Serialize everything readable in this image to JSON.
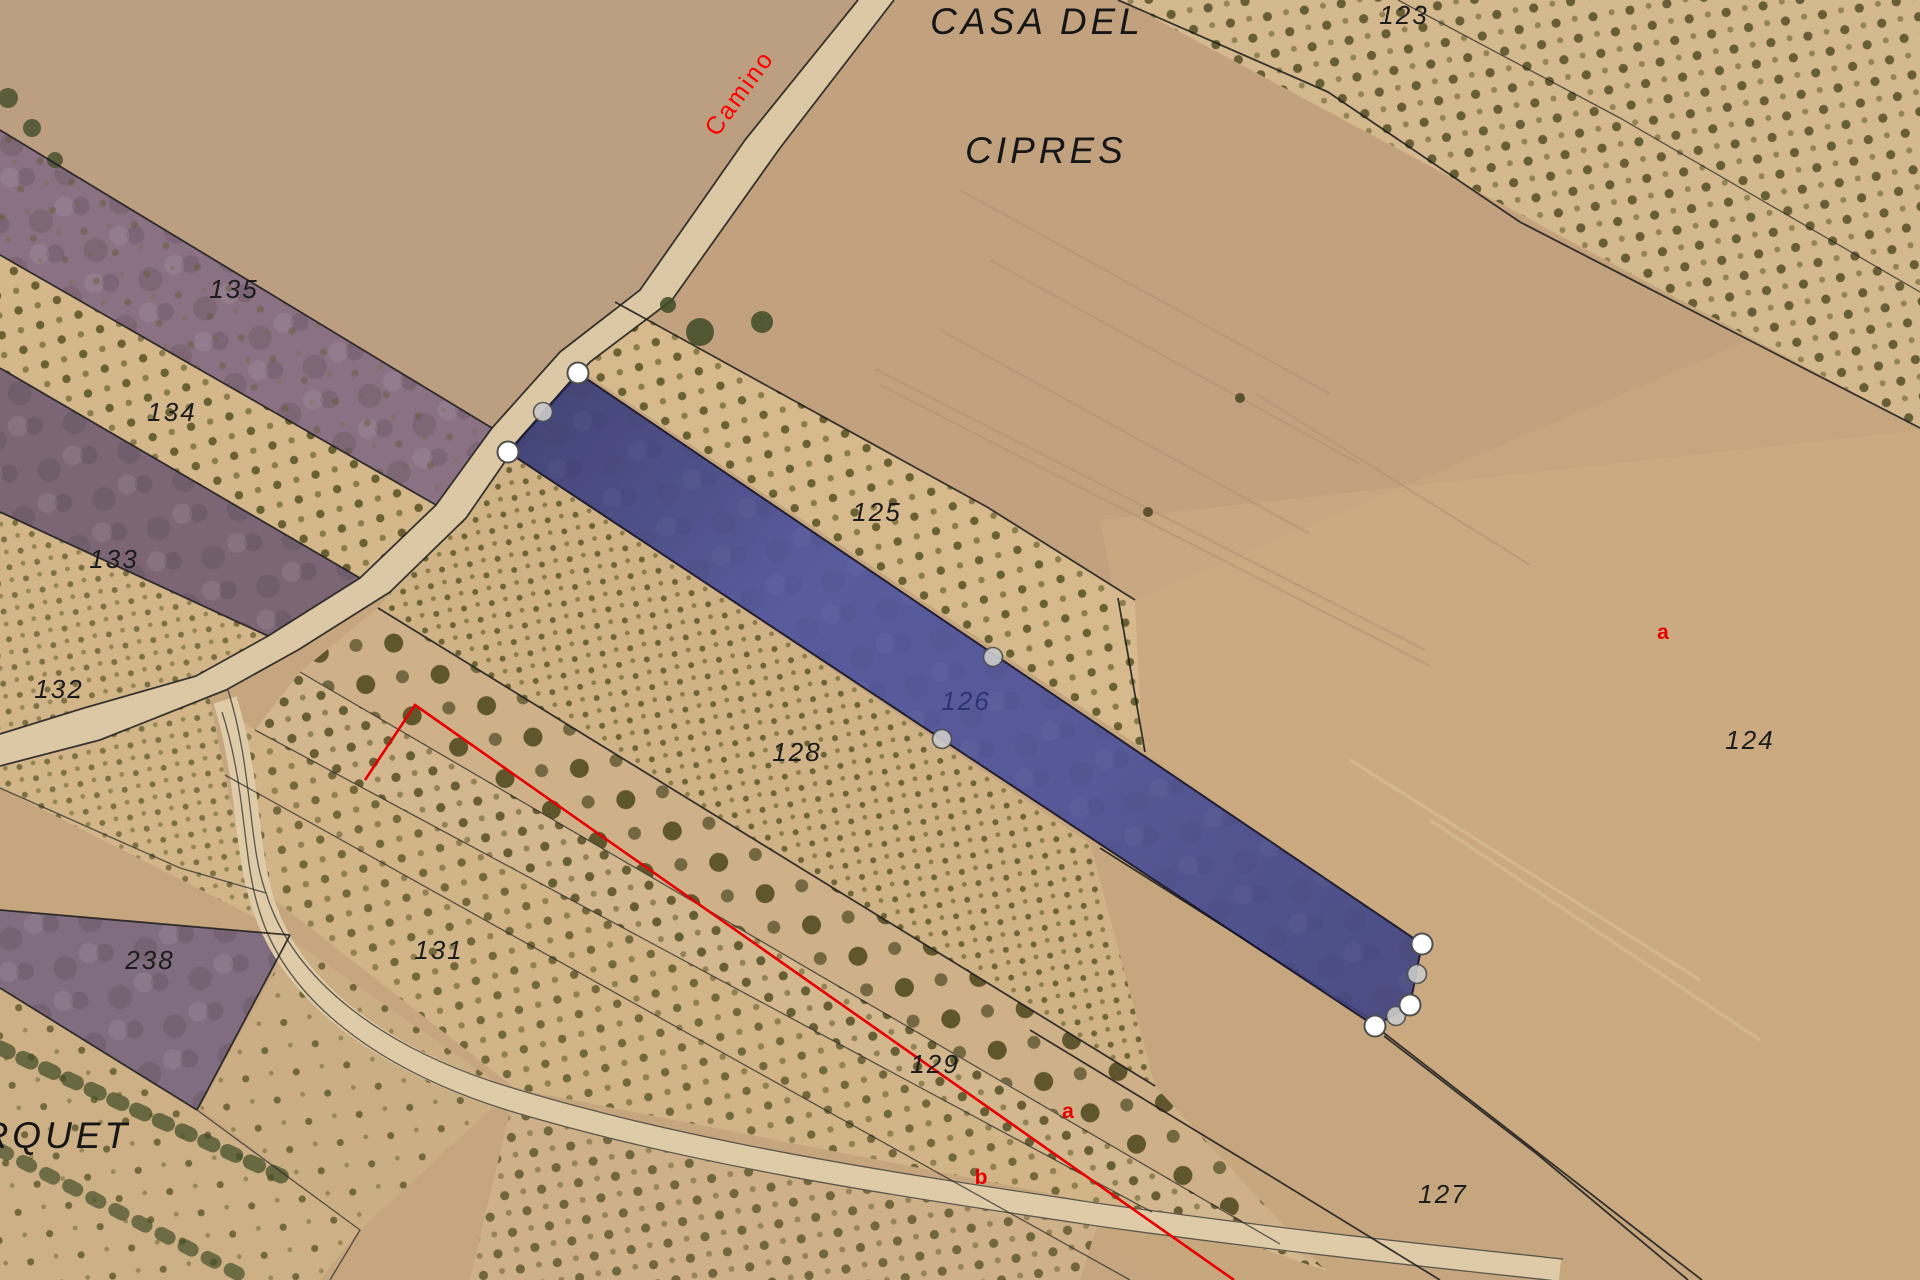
{
  "map": {
    "type": "cadastral-aerial-map",
    "place_labels": [
      {
        "id": "casa-del",
        "text": "CASA DEL",
        "x": 1037,
        "y": 34
      },
      {
        "id": "cipres",
        "text": "CIPRES",
        "x": 1046,
        "y": 163
      },
      {
        "id": "arquet",
        "text": "ARQUET",
        "x": 42,
        "y": 1148
      }
    ],
    "road_label": {
      "text": "Camino",
      "x": 746,
      "y": 98,
      "rotation": -54,
      "color": "#ff0000"
    },
    "parcel_labels": [
      {
        "number": "123",
        "x": 1404,
        "y": 24
      },
      {
        "number": "135",
        "x": 234,
        "y": 298
      },
      {
        "number": "134",
        "x": 172,
        "y": 421
      },
      {
        "number": "133",
        "x": 114,
        "y": 568
      },
      {
        "number": "132",
        "x": 59,
        "y": 698
      },
      {
        "number": "125",
        "x": 877,
        "y": 521
      },
      {
        "number": "126",
        "x": 966,
        "y": 710,
        "on_selection": true
      },
      {
        "number": "128",
        "x": 797,
        "y": 761
      },
      {
        "number": "124",
        "x": 1750,
        "y": 749
      },
      {
        "number": "238",
        "x": 150,
        "y": 969
      },
      {
        "number": "131",
        "x": 439,
        "y": 959
      },
      {
        "number": "129",
        "x": 935,
        "y": 1073
      },
      {
        "number": "127",
        "x": 1443,
        "y": 1203
      }
    ],
    "subparcel_labels": [
      {
        "text": "a",
        "x": 1663,
        "y": 639
      },
      {
        "text": "a",
        "x": 1068,
        "y": 1118
      },
      {
        "text": "b",
        "x": 981,
        "y": 1184
      }
    ],
    "selected_parcel": {
      "number": "126",
      "fill_start": "#383c78",
      "fill_mid": "#4d53a0",
      "fill_end": "#3f4484",
      "outline": "#101028",
      "vertices": [
        [
          578,
          373
        ],
        [
          1422,
          944
        ],
        [
          1410,
          1005
        ],
        [
          1375,
          1026
        ],
        [
          508,
          452
        ]
      ],
      "vertex_handles": [
        [
          578,
          373
        ],
        [
          508,
          452
        ],
        [
          1422,
          944
        ],
        [
          1410,
          1005
        ],
        [
          1375,
          1026
        ]
      ],
      "midpoint_handles": [
        [
          543,
          412
        ],
        [
          993,
          657
        ],
        [
          942,
          739
        ],
        [
          1417,
          974
        ],
        [
          1396,
          1016
        ]
      ],
      "vertex_handle_fill": "#ffffff",
      "midpoint_handle_fill": "#c9c9c9",
      "handle_stroke": "#4f4f4f"
    },
    "red_overlay": {
      "color": "#e60000",
      "polyline": [
        [
          365,
          780
        ],
        [
          415,
          705
        ],
        [
          1234,
          1280
        ]
      ]
    },
    "colors": {
      "ground_tan": "#c6a67f",
      "field_pink": "#c09c80",
      "field_light": "#d4b88e",
      "purple_field": "#8a7183",
      "purple_dark": "#7c6676",
      "purple_238": "#816d80",
      "road_fill": "#dcc8a4",
      "olive_tree": "#574f26",
      "boundary_black": "#1b1b1b"
    }
  }
}
